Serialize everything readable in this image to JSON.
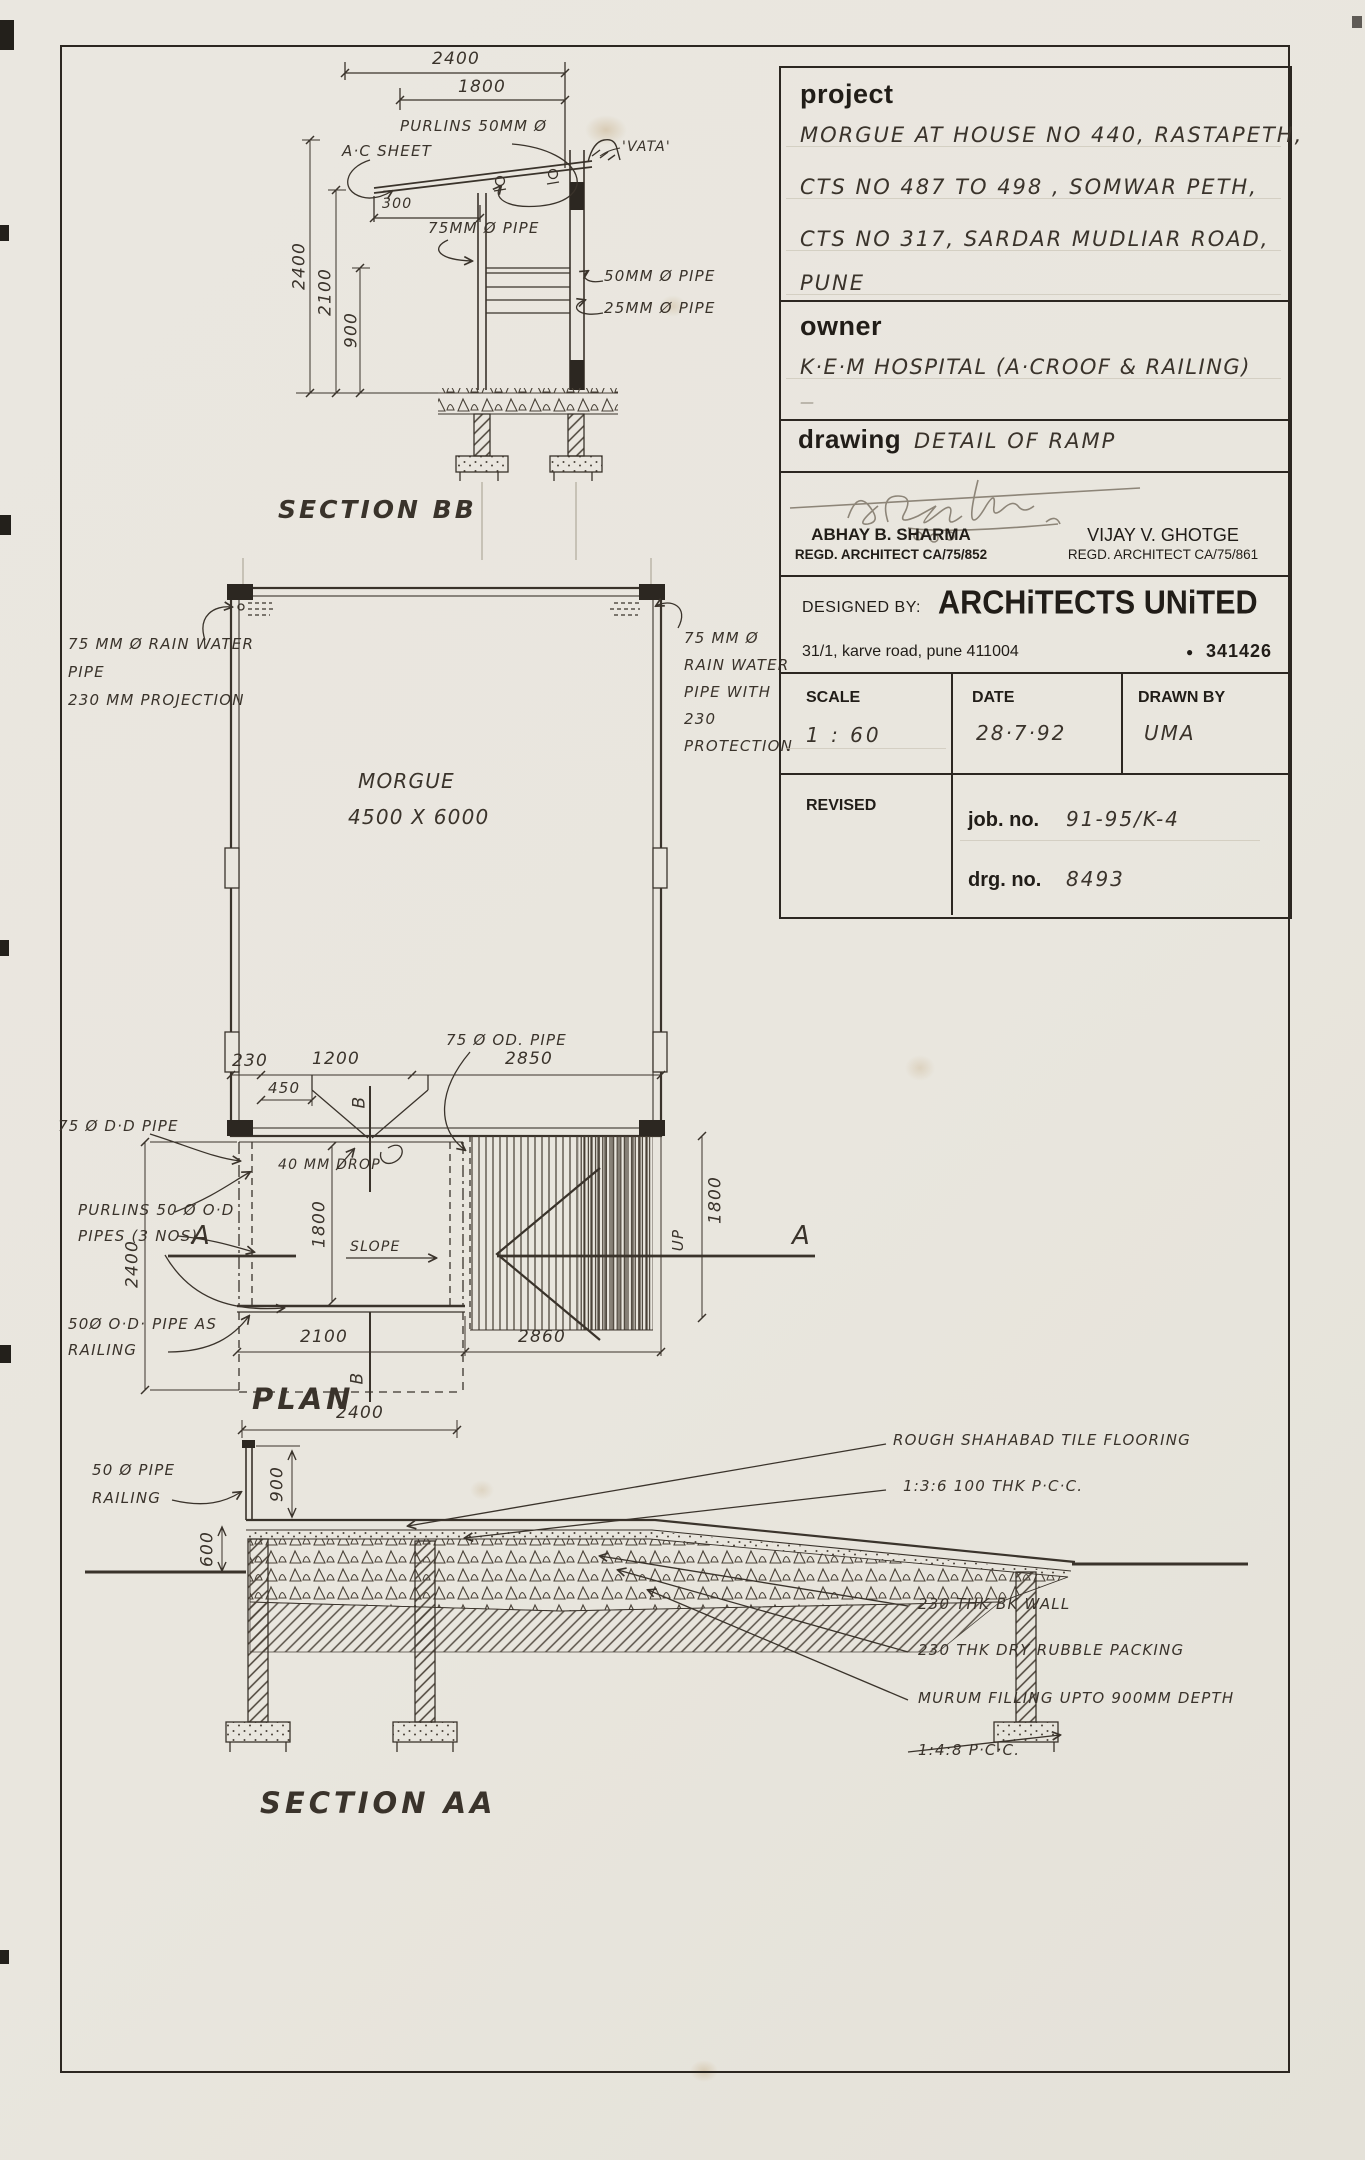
{
  "colors": {
    "paper": "#e9e6de",
    "ink": "#3a332b",
    "heavy_ink": "#2c2721",
    "pencil": "#a59d8e"
  },
  "tb": {
    "project_label": "project",
    "project_lines": [
      "MORGUE AT HOUSE NO 440, RASTAPETH,",
      "CTS NO 487 TO 498 , SOMWAR PETH,",
      "CTS NO 317, SARDAR MUDLIAR ROAD,",
      "PUNE"
    ],
    "owner_label": "owner",
    "owner_value": "K·E·M  HOSPITAL  (A·CROOF & RAILING)",
    "owner_dash": "—",
    "drawing_label": "drawing",
    "drawing_value": "DETAIL OF RAMP",
    "architect1_name": "ABHAY B. SHARMA",
    "architect1_reg": "REGD. ARCHITECT CA/75/852",
    "architect2_name": "VIJAY V. GHOTGE",
    "architect2_reg": "REGD. ARCHITECT CA/75/861",
    "designed_by_label": "DESIGNED BY:",
    "firm_name": "ARCHiTECTS  UNiTED",
    "firm_address": "31/1, karve road, pune 411004",
    "phone_bullet": "●",
    "firm_phone": "341426",
    "scale_label": "SCALE",
    "scale_value": "1 : 60",
    "date_label": "DATE",
    "date_value": "28·7·92",
    "drawn_label": "DRAWN BY",
    "drawn_value": "UMA",
    "revised_label": "REVISED",
    "job_label": "job. no.",
    "job_value": "91-95/K-4",
    "drg_label": "drg. no.",
    "drg_value": "8493"
  },
  "sb": {
    "title": "SECTION BB",
    "d2400": "2400",
    "d1800": "1800",
    "d300": "300",
    "v2400": "2400",
    "v2100": "2100",
    "v900": "900",
    "purlins": "PURLINS 50MM Ø",
    "ac": "A·C SHEET",
    "vata": "'VATA'",
    "p75": "75MM Ø PIPE",
    "p50": "50MM Ø PIPE",
    "p25": "25MM Ø PIPE"
  },
  "plan": {
    "title": "PLAN",
    "morgue": "MORGUE",
    "size": "4500 X 6000",
    "rwl1": "75 MM Ø RAIN WATER",
    "rwl2": "PIPE",
    "rwl3": "230 MM PROJECTION",
    "rwr1": "75 MM Ø",
    "rwr2": "RAIN WATER",
    "rwr3": "PIPE WITH",
    "rwr4": "230",
    "rwr5": "PROTECTION",
    "d230": "230",
    "d1200": "1200",
    "d2850": "2850",
    "d450": "450",
    "drop": "40 MM DROP",
    "pipeL": "75 Ø D·D PIPE",
    "pipeR": "75 Ø OD. PIPE",
    "purl1": "PURLINS 50 Ø O·D",
    "purl2": "PIPES (3 NOS)",
    "rail1": "50Ø O·D· PIPE AS",
    "rail2": "RAILING",
    "slope": "SLOPE",
    "up": "UP",
    "a": "A",
    "b": "B",
    "v1800": "1800",
    "v2400": "2400",
    "v1800r": "1800",
    "d2100": "2100",
    "d2860": "2860",
    "d2400b": "2400"
  },
  "aa": {
    "title": "SECTION AA",
    "rail1": "50 Ø PIPE",
    "rail2": "RAILING",
    "v900": "900",
    "v600": "600",
    "an1": "ROUGH SHAHABAD TILE FLOORING",
    "an2": "1:3:6  100 THK  P·C·C.",
    "an3": "230 THK  BK WALL",
    "an4": "230 THK  DRY RUBBLE PACKING",
    "an5": "MURUM  FILLING  UPTO 900MM  DEPTH",
    "an6": "1:4:8  P·C·C."
  }
}
